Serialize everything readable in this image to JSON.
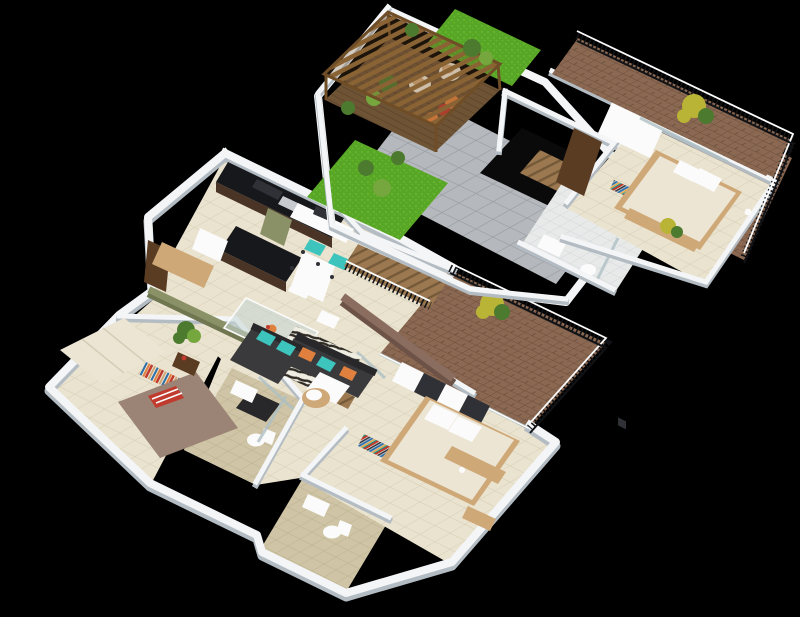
{
  "scene": {
    "description": "3D isometric render of a two-level apartment floor plan on a black background",
    "levels": [
      {
        "name": "roof-terrace-level",
        "rooms": [
          "pergola-deck",
          "lawn",
          "paved-terrace",
          "stairwell",
          "bathroom",
          "bedroom",
          "brick-balconies"
        ],
        "furniture": [
          "wooden-pergola",
          "two-cream-tub-chairs",
          "potted-plants",
          "orange-flowers",
          "double-bed",
          "cube-shelf",
          "wardrobe-panel",
          "toilet",
          "sink",
          "glass-shower"
        ]
      },
      {
        "name": "main-floor-level",
        "rooms": [
          "kitchen",
          "entry",
          "dining-area",
          "study-nook",
          "living-room",
          "wooden-staircase",
          "left-bedroom",
          "center-bathroom",
          "lower-bathroom",
          "right-bedroom",
          "brick-balcony"
        ],
        "furniture": [
          "dark-kitchen-counter",
          "island",
          "fridge",
          "glass-dining-table",
          "four-white-chairs",
          "desk-with-two-teal-chairs",
          "charcoal-sectional-sofa",
          "teal-and-orange-pillows",
          "zebra-rug",
          "white-coffee-table",
          "dark-ottoman",
          "wicker-bowl-chair",
          "mauve-bed-with-striped-pillow",
          "cream-wardrobe",
          "striped-runner-rug",
          "double-bed-cream",
          "white-cube-wardrobe",
          "colorful-bookshelf",
          "toilets",
          "sinks",
          "plants"
        ]
      }
    ]
  },
  "palette": {
    "bg": "#000000",
    "wallTop": "#f3f5f6",
    "wallShade": "#b4bcc3",
    "floorCream": "#eae3cf",
    "grout": "#d5cdb5",
    "floorBeige": "#cfc5a6",
    "groutBeige": "#bbb08f",
    "tileWhite": "#e8eaea",
    "groutWhite": "#d0d4d5",
    "pave": "#b5b8bc",
    "paveLine": "#979ca1",
    "brick": "#8a6852",
    "brickLine": "#6d503d",
    "grass": "#58a626",
    "grassLight": "#6fbe33",
    "deck": "#6e5335",
    "deckLine": "#584128",
    "pergola": "#8a6335",
    "pergolaDark": "#6e4d27",
    "woodStep": "#9b7850",
    "woodStepDark": "#755a39",
    "counter": "#17181b",
    "cabinet": "#4a3425",
    "steel": "#c7cbd0",
    "olive": "#8a9166",
    "oliveDark": "#6f7650",
    "teal": "#3cc4bd",
    "sofa": "#3a3a3d",
    "sofaDark": "#28282b",
    "orange": "#e0803f",
    "zebraWhite": "#efece1",
    "zebraBlack": "#2e2a24",
    "taupe": "#8b6d60",
    "taupeDark": "#6d5247",
    "mauve": "#9b8375",
    "red": "#c03a2e",
    "creamFurn": "#ece5d4",
    "tan": "#cfa878",
    "glass": "#aebfc4",
    "glassFill": "#c4d6d4",
    "railing": "#121316",
    "plant": "#4c7a2f",
    "plantLight": "#76a73e",
    "plantYellow": "#b9b435",
    "white": "#fbfbfb",
    "shelfDark": "#2f3136",
    "doorBrown": "#5a3c22",
    "bookRed": "#c0392b",
    "bookBlue": "#2d6ea8",
    "bookOrange": "#e9a13b",
    "bookTeal": "#1e8f82"
  }
}
